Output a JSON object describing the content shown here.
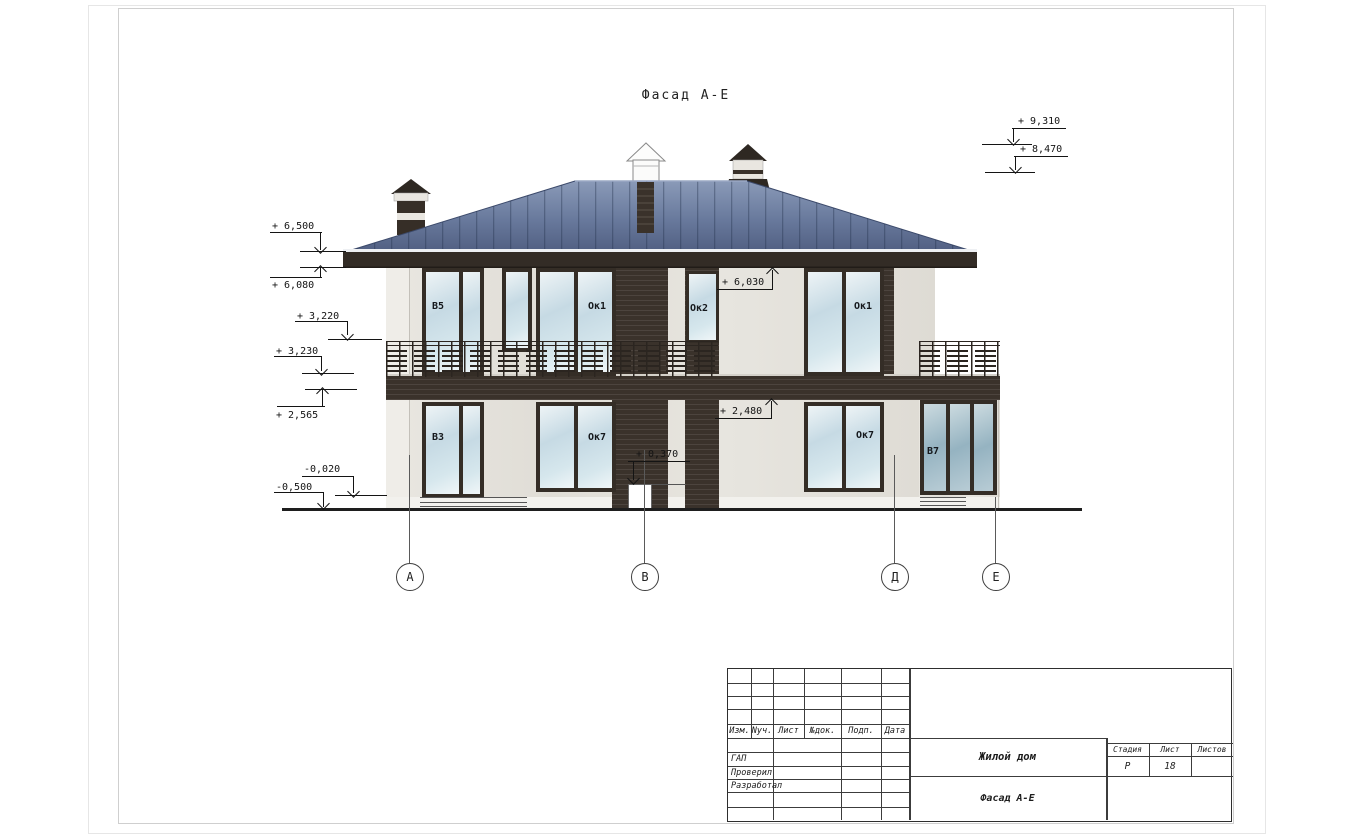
{
  "drawing": {
    "title": "Фасад А-Е",
    "marks": {
      "left": [
        "+ 6,500",
        "+ 6,080",
        "+ 3,220",
        "+ 3,230",
        "+ 2,565",
        "-0,020",
        "-0,500"
      ],
      "right": [
        "+ 9,310",
        "+ 8,470"
      ],
      "facade": [
        "+ 6,030",
        "+ 2,480",
        "+ 0,370"
      ]
    },
    "windows": {
      "upper": [
        {
          "label": "В5"
        },
        {
          "label": "Ок1"
        },
        {
          "label": "Ок2"
        },
        {
          "label": "Ок1"
        }
      ],
      "lower": [
        {
          "label": "В3"
        },
        {
          "label": "Ок7"
        },
        {
          "label": "Ок7"
        },
        {
          "label": "В7"
        }
      ]
    },
    "axes": [
      {
        "label": "А"
      },
      {
        "label": "В"
      },
      {
        "label": "Д"
      },
      {
        "label": "Е"
      }
    ]
  },
  "title_block": {
    "header_columns": [
      "Изм.",
      "Nуч.",
      "Лист",
      "№док.",
      "Подп.",
      "Дата"
    ],
    "signature_rows": [
      "ГАП",
      "Проверил",
      "Разработал"
    ],
    "project_name": "Жилой дом",
    "drawing_name": "Фасад А-Е",
    "stage_label": "Стадия",
    "sheet_label": "Лист",
    "sheets_label": "Листов",
    "stage": "Р",
    "sheet_number": "18",
    "sheets_total": ""
  },
  "colors": {
    "roof": "#68799c",
    "dark_trim": "#3a322b",
    "wall": "#e6e4de",
    "glass": "#c6dae4",
    "glass_dark": "#95b3c1",
    "line": "#141414"
  }
}
